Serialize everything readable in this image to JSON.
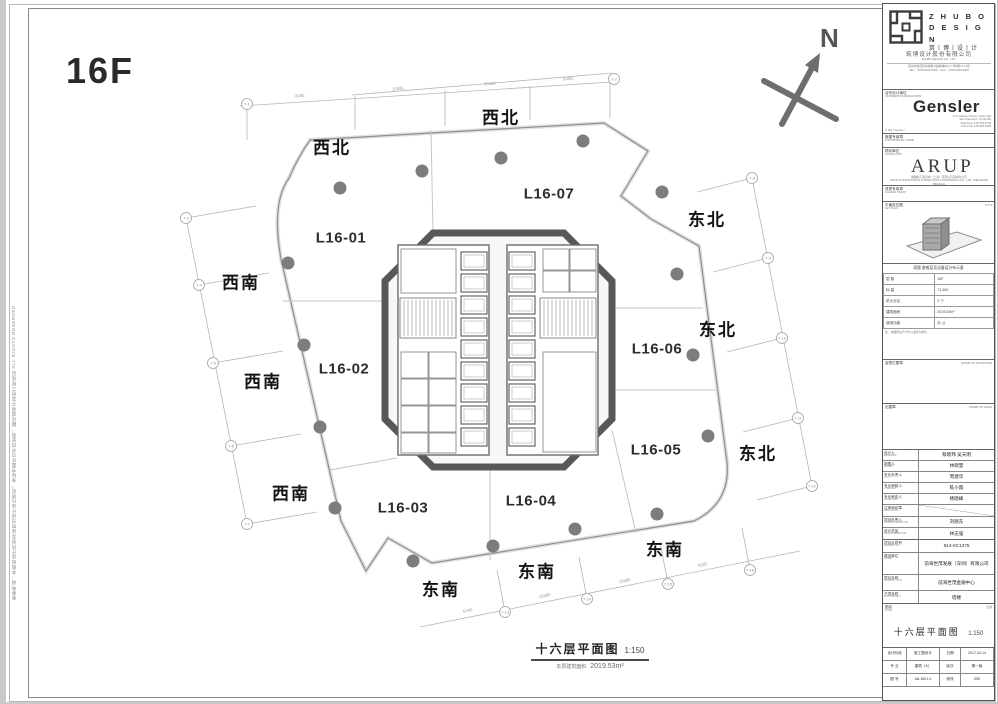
{
  "floor_label": "16F",
  "north_label": "N",
  "side_note": "重要申明：本图纸设计内容及版权归设计单位所有，未经书面许可不得复制、翻印或用于其他工程项目 ALL RIGHTS RESERVED",
  "plan": {
    "units": [
      "L16-01",
      "L16-02",
      "L16-03",
      "L16-04",
      "L16-05",
      "L16-06",
      "L16-07"
    ],
    "dir_nw": "西北",
    "dir_ne": "东北",
    "dir_sw": "西南",
    "dir_se": "东南",
    "grid_labels": [
      "7-1",
      "7-2",
      "7-3",
      "7-4",
      "7-5",
      "7-6",
      "7-7",
      "7-8",
      "7-9",
      "7-10",
      "7-11",
      "7-12",
      "7-13",
      "7-14",
      "7-15",
      "7-16"
    ],
    "dims": [
      "8295",
      "10495",
      "10480",
      "10495",
      "6795",
      "10495",
      "10480",
      "6285"
    ],
    "caption_title": "十六层平面图",
    "caption_scale": "1:150",
    "caption_area_label": "本层建筑面积",
    "caption_area_value": "2019.53m²"
  },
  "tb": {
    "zhubo_en1": "Z H U B O",
    "zhubo_en2": "D E S I G N",
    "zhubo_cn": "筑丨博丨设丨计",
    "zhubo_co_cn": "筑博设计股份有限公司",
    "zhubo_co_en": "ZHUBO DESIGN CO., LTD.",
    "zhubo_addr1": "深圳市福田区梅林路卓越梅林中心广场B座11-13层",
    "zhubo_addr2": "TEL：0755-8339 9999　FAX：0755-8339 9998",
    "partner_label": "合作设计单位",
    "partner_en": "COOPERATIVE DESIGN FIRM",
    "gensler_name": "Gensler",
    "gensler_addr1": "Two Harrison Street, Suite 400",
    "gensler_addr2": "San Francisco, CA 94105",
    "gensler_addr3": "Telephone 415.433.3700",
    "gensler_addr4": "Facsimile 415.836.4599",
    "gensler_copy": "© 2017 Gensler",
    "stamp1_label": "报建专用章",
    "stamp1_en": "FOR APPROVAL STAMP",
    "consult_label": "顾问单位",
    "consult_en": "CONSULTANT",
    "arup_name": "ARUP",
    "arup_line1": "奥雅纳工程咨询（上海）有限公司深圳分公司",
    "arup_line2": "ARUP INTERNATIONAL CONSULTANTS (SHANGHAI) CO., LTD. SHENZHEN BRANCH",
    "stamp2_label": "资质专用章",
    "stamp2_en": "LICENSE STAMP",
    "keyplan_label": "平面定位图",
    "keyplan_en": "KEY PLAN",
    "keyplan_scale": "N.T.S",
    "sched_header": "塔楼 避难层及设备层分布示意",
    "sched_rows": [
      [
        "层 数",
        "16F"
      ],
      [
        "标 高",
        "71.400"
      ],
      [
        "防火分区",
        "2 个"
      ],
      [
        "建筑面积",
        "2019.53m²"
      ],
      [
        "使用功能",
        "办 公"
      ]
    ],
    "sched_note": "注：本图所注尺寸均以毫米为单位",
    "sign_label": "会签栏图章",
    "sign_en": "STAMP OF SIGNATURE",
    "issue_label": "出图章",
    "issue_en": "STAMP OF ISSUE",
    "personnel": [
      {
        "label": "设计人",
        "en": "DESIGNED",
        "value": "蔡晓玮 吴天明"
      },
      {
        "label": "制图人",
        "en": "DRAWN",
        "value": "林晓慧"
      },
      {
        "label": "专业负责人",
        "en": "P.I.C.",
        "value": "周建华"
      },
      {
        "label": "专业审核人",
        "en": "CHECKED",
        "value": "陈小霞"
      },
      {
        "label": "专业审定人",
        "en": "APPROVED",
        "value": "杨晓峰"
      },
      {
        "label": "注册师印章",
        "en": "REG. STAMP",
        "value": ""
      },
      {
        "label": "项目负责人",
        "en": "PROJECT DIRECTOR",
        "value": "刘晓东"
      },
      {
        "label": "设计总监",
        "en": "DESIGN DIRECTOR",
        "value": "林志强"
      }
    ],
    "proj_no_label": "项目合同号",
    "proj_no_en": "PROJECT No.",
    "proj_no": "814-SC1275",
    "client_label": "建设单位",
    "client_en": "CLIENT",
    "client": "前海世茂发展（深圳）有限公司",
    "proj_label": "项目名称",
    "proj_en": "PROJECT TITLE",
    "proj": "前海世茂金融中心",
    "sub_label": "子项名称",
    "sub_en": "SUB PROJECT",
    "sub": "塔楼",
    "title_label": "图名",
    "title_en": "TITLE",
    "scale_label": "比例",
    "scale_en": "SCALE",
    "dwg_title": "十六层平面图",
    "dwg_scale": "1:150",
    "footer": {
      "r1c1": "设计阶段",
      "r1c2": "施工图设计",
      "r1c3": "日期",
      "r1c4": "2017.04.14",
      "r2c1": "专 业",
      "r2c2": "建筑（A）",
      "r2c3": "版次",
      "r2c4": "第一版",
      "r3c1": "图 号",
      "r3c2": "A8-1601.4",
      "r3c3": "修改",
      "r3c4": "005"
    }
  }
}
